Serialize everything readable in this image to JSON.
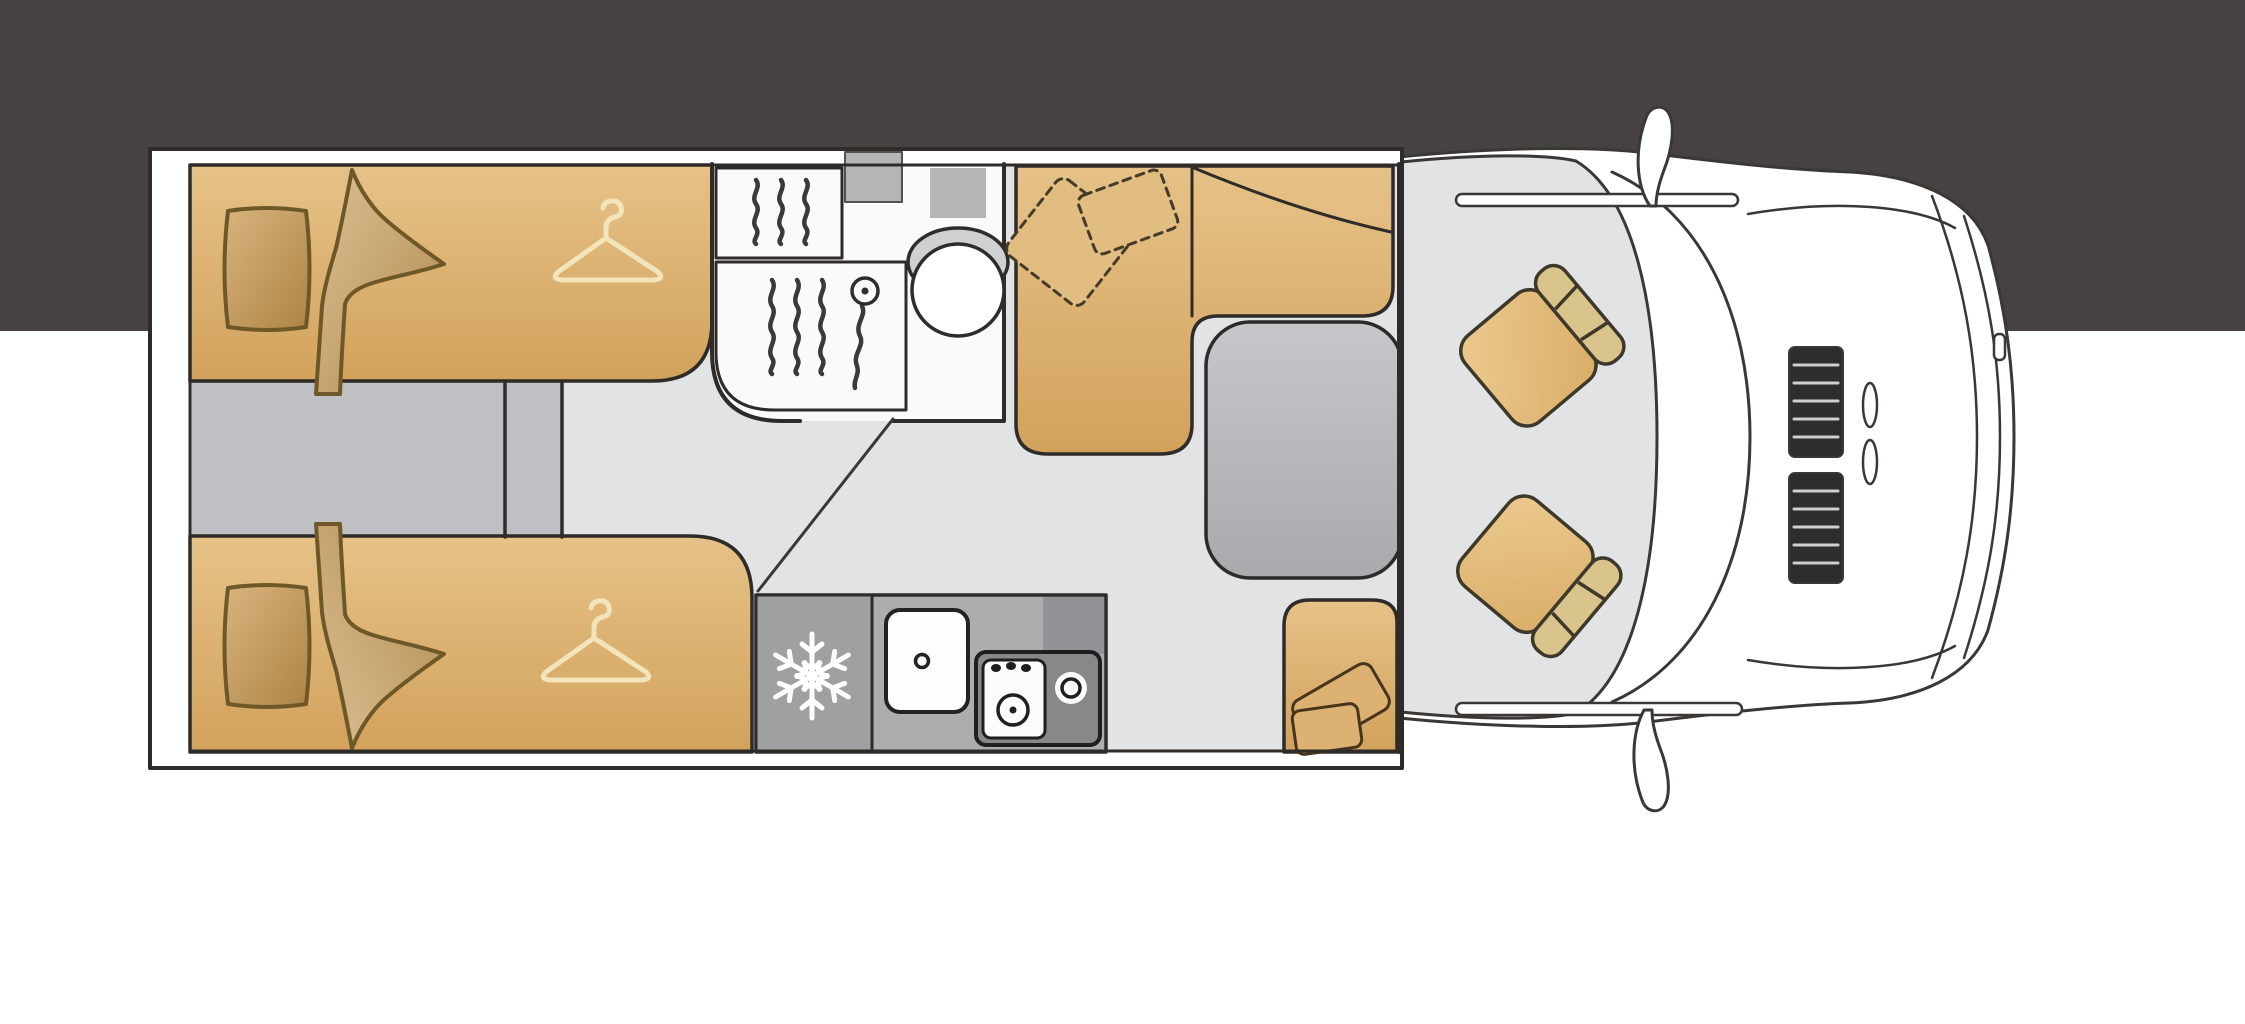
{
  "palette": {
    "band": "#474241",
    "page": "#ffffff",
    "plan_stroke": "#2e2b28",
    "soft_stroke": "#6f5828",
    "floor_light": "#e2e3e5",
    "floor_aisle": "#bfc0c4",
    "bed_tan": "#ddb273",
    "hanger": "#f2e4bb",
    "bath_white": "#fafafa",
    "shelf_gray": "#b4b5b7",
    "kitchen_gray": "#acadaf",
    "fridge_gray": "#9fa0a2",
    "hob_gray": "#87888a",
    "table_gray": "#b9babe",
    "cab_stroke": "#3a3734",
    "grille_dark": "#2d2d2d"
  },
  "icons": {
    "snowflake": "refrigerator symbol",
    "hanger": "wardrobe symbol",
    "shower_waves": "shower water lines",
    "shower_head": "shower head on hose",
    "toilet": "toilet bowl with rim",
    "sink": "kitchen sink with drain",
    "hob": "two burner hob with knobs"
  },
  "regions": {
    "bedroom": "twin single beds with pillows, duvets and wardrobes",
    "aisle": "step aisle between the twin beds",
    "bathroom": "shower room with shower tray and toilet",
    "kitchen": "kitchen block with fridge, sink and hob",
    "lounge": "L-shaped sofa with cushions and pedestal table",
    "travel_seat": "forward facing travel seat",
    "cab": "driver cab with two swivelled captain seats, windscreen, bonnet and grille"
  }
}
